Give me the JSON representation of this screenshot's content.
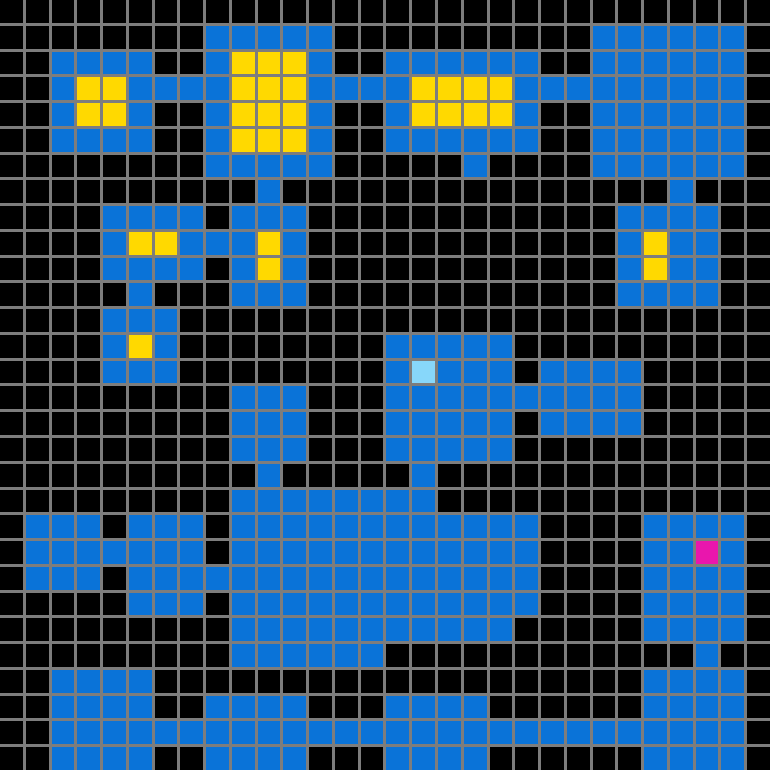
{
  "map": {
    "title": "tile-dungeon-map",
    "rows": 30,
    "cols": 30,
    "cell_size_px": 25.67,
    "gridline_px": 3,
    "colors": {
      "empty": "#000000",
      "floor": "#0a73d8",
      "gold": "#ffd900",
      "cyan_unit": "#87d7fa",
      "magenta_unit": "#e916ad",
      "gridline": "#7d7d7d"
    },
    "legend": {
      ".": "empty",
      "B": "floor",
      "Y": "gold",
      "C": "cyan_unit",
      "M": "magenta_unit"
    },
    "special_cells": [
      {
        "type": "cyan_unit",
        "row": 14,
        "col": 16
      },
      {
        "type": "magenta_unit",
        "row": 21,
        "col": 27
      }
    ],
    "grid": [
      "..............................",
      "........BBBBB..........BBBBBB.",
      "..BBBB..BYYYB..BBBBBB..BBBBBB.",
      "..BYYBBBBYYYBBBBYYYYBBBBBBBBB.",
      "..BYYB..BYYYB..BYYYYB..BBBBBB.",
      "..BBBB..BYYYB..BBBBBB..BBBBBB.",
      "........BBBBB.....B....BBBBBB.",
      "..........B...............B...",
      "....BBBB.BBB............BBBB..",
      "....BYYBBBYB............BYBB..",
      "....BBBB.BYB............BYBB..",
      ".....B...BBB............BBBB..",
      "....BBB.......................",
      "....BYB........BBBBB..........",
      "....BBB........BCBBB.BBBB.....",
      ".........BBB...BBBBBBBBBB.....",
      ".........BBB...BBBBB.BBBB.....",
      ".........BBB...BBBBB..........",
      "..........B.....B.............",
      ".........BBBBBBBB.............",
      ".BBB.BBB.BBBBBBBBBBBB....BBBB.",
      ".BBBBBBB.BBBBBBBBBBBB....BBMB.",
      ".BBB.BBBBBBBBBBBBBBBB....BBBB.",
      ".....BBB.BBBBBBBBBBBB....BBBB.",
      ".........BBBBBBBBBBB.....BBBB.",
      ".........BBBBBB............B..",
      "..BBBB...................BBBB.",
      "..BBBB..BBBB...BBBB......BBBB.",
      "..BBBBBBBBBBBBBBBBBBBBBBBBBBB.",
      "..BBBB..BBBB...BBBB......BBBB."
    ]
  }
}
